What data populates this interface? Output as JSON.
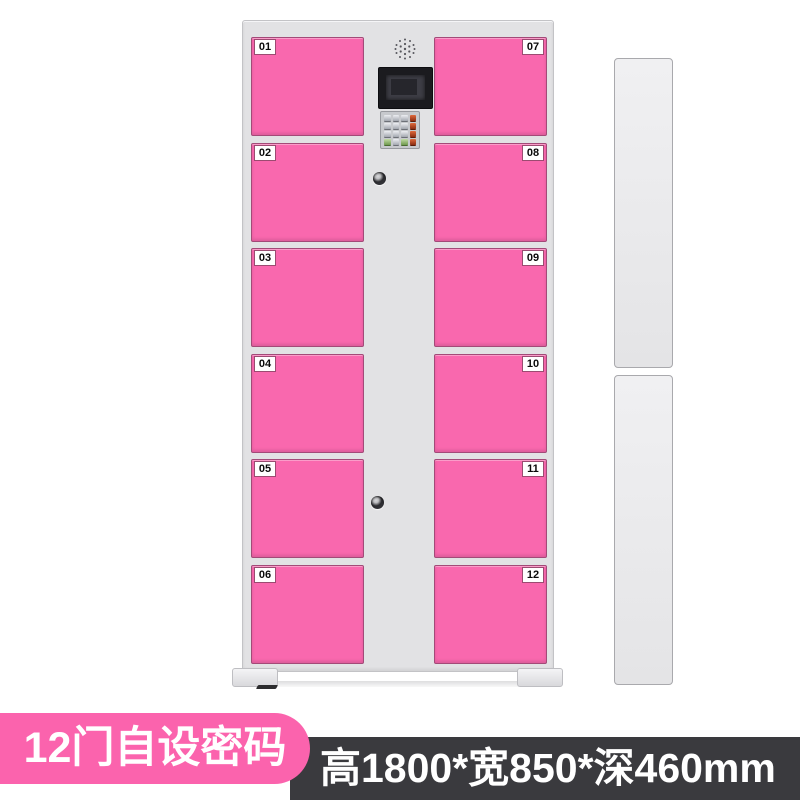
{
  "locker": {
    "left_column_doors": [
      {
        "number": "01"
      },
      {
        "number": "02"
      },
      {
        "number": "03"
      },
      {
        "number": "04"
      },
      {
        "number": "05"
      },
      {
        "number": "06"
      }
    ],
    "right_column_doors": [
      {
        "number": "07"
      },
      {
        "number": "08"
      },
      {
        "number": "09"
      },
      {
        "number": "10"
      },
      {
        "number": "11"
      },
      {
        "number": "12"
      }
    ],
    "control_panel": {
      "speaker_icon": "speaker-grille-icon",
      "screen_icon": "display-screen",
      "keypad_icon": "numeric-keypad",
      "keyhole_icon": "keyhole-icon"
    }
  },
  "banners": {
    "feature_label": "12门自设密码",
    "dimensions_label": "高1800*宽850*深460mm"
  },
  "colors": {
    "door_pink": "#f968ae",
    "feature_banner_pink": "#fb63ad",
    "dimensions_banner_dark": "#3a3a3e",
    "cabinet_gray": "#e2e2e4",
    "door_label_bg": "#ffffff",
    "door_label_text": "#0a0a0a",
    "banner_text": "#ffffff",
    "keypad_red_keys": "#b5451f",
    "keypad_green_keys": "#7fa35b",
    "screen_bezel": "#1b1b1f"
  }
}
